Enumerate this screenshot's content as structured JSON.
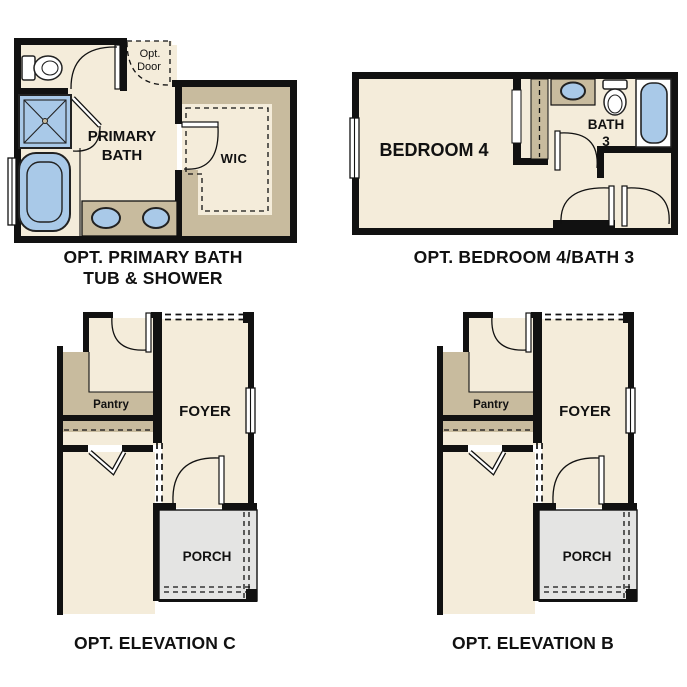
{
  "colors": {
    "background": "#ffffff",
    "wall": "#111111",
    "floor_cream": "#f4ecda",
    "cabinet_tan": "#c8bb9e",
    "fixture_blue": "#a9c9e8",
    "porch_gray": "#e4e4e3",
    "text": "#111111"
  },
  "plans": {
    "primary_bath": {
      "title_line1": "OPT. PRIMARY BATH",
      "title_line2": "TUB & SHOWER",
      "room_line1": "PRIMARY",
      "room_line2": "BATH",
      "closet_label": "WIC",
      "opt_door_line1": "Opt.",
      "opt_door_line2": "Door"
    },
    "bedroom4_bath3": {
      "title": "OPT. BEDROOM 4/BATH 3",
      "bedroom_label": "BEDROOM 4",
      "bath_line1": "BATH",
      "bath_line2": "3"
    },
    "elevations": {
      "pantry_label": "Pantry",
      "foyer_label": "FOYER",
      "porch_label": "PORCH",
      "c_title": "OPT. ELEVATION C",
      "b_title": "OPT. ELEVATION B"
    }
  }
}
